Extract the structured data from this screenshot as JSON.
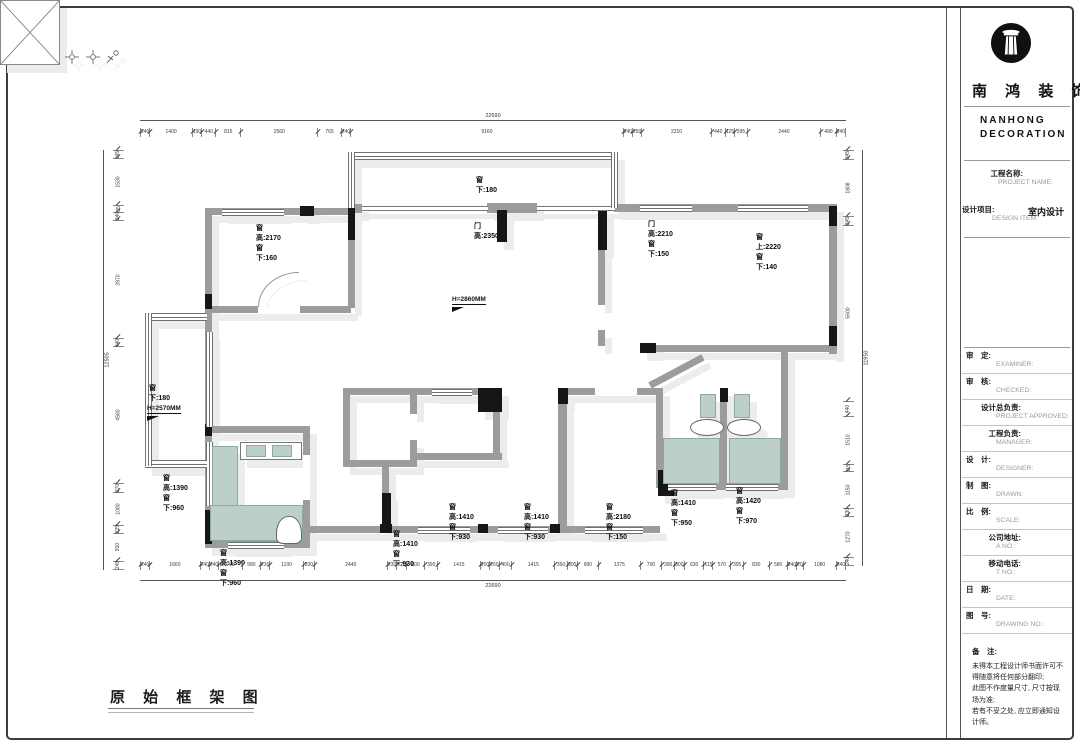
{
  "brand": {
    "cn": "南 鸿 装 饰",
    "en1": "NANHONG",
    "en2": "DECORATION"
  },
  "title_block": {
    "project": {
      "cn": "　　　工程名称:",
      "en": "PROJECT NAME:"
    },
    "design_item": {
      "cn": "设计项目:",
      "en": "DESIGN ITEM:",
      "value": "室内设计"
    },
    "fields": [
      {
        "cn": "审　定:",
        "en": "EXAMINER:"
      },
      {
        "cn": "审　核:",
        "en": "CHECKED:"
      },
      {
        "cn": "　　设计总负责:",
        "en": "PROJECT APPROVED:"
      },
      {
        "cn": "　　　工程负责:",
        "en": "MANAGER:"
      },
      {
        "cn": "设　计:",
        "en": "DESIGNER:"
      },
      {
        "cn": "制　图:",
        "en": "DRAWN:"
      },
      {
        "cn": "比　例:",
        "en": "SCALE:"
      },
      {
        "cn": "　　　公司地址:",
        "en": "A  NO.:"
      },
      {
        "cn": "　　　移动电话:",
        "en": "T  NO.:"
      },
      {
        "cn": "日　期:",
        "en": "DATE:"
      },
      {
        "cn": "图　号:",
        "en": "DRAWING NO.:"
      }
    ],
    "notes": {
      "label": "备　注:",
      "lines": [
        "未得本工程设计师书面许可不",
        "得随意将任何部分翻印;",
        "此图不作度量尺寸, 尺寸按现",
        "场为准;",
        "若有不妥之处, 应立即通知设",
        "计师。"
      ]
    }
  },
  "drawing_title": "原 始 框 架 图",
  "plan": {
    "annotations": [
      {
        "text": "窗高:2170\n窗下:160",
        "x": 256,
        "y": 224
      },
      {
        "text": "窗下:180",
        "x": 476,
        "y": 176
      },
      {
        "text": "门高:2350",
        "x": 474,
        "y": 222
      },
      {
        "text": "门高:2210\n窗下:150",
        "x": 648,
        "y": 220
      },
      {
        "text": "窗上:2220\n窗下:140",
        "x": 756,
        "y": 233
      },
      {
        "text": "窗下:180",
        "x": 149,
        "y": 384
      },
      {
        "text": "窗高:1390\n窗下:960",
        "x": 163,
        "y": 474
      },
      {
        "text": "窗高:1390\n窗下:960",
        "x": 220,
        "y": 549
      },
      {
        "text": "窗高:1410\n窗下:930",
        "x": 393,
        "y": 530
      },
      {
        "text": "窗高:1410\n窗下:930",
        "x": 449,
        "y": 503
      },
      {
        "text": "窗高:1410\n窗下:930",
        "x": 524,
        "y": 503
      },
      {
        "text": "窗高:2180\n窗下:150",
        "x": 606,
        "y": 503
      },
      {
        "text": "窗高:1410\n窗下:950",
        "x": 671,
        "y": 489
      },
      {
        "text": "窗高:1420\n窗下:970",
        "x": 736,
        "y": 487
      }
    ],
    "elevations": [
      {
        "text": "H=2860MM",
        "x": 452,
        "y": 288
      },
      {
        "text": "H=2570MM",
        "x": 147,
        "y": 397
      }
    ],
    "dims": {
      "top_total": "22690",
      "bottom_total": "22690",
      "left_total": "12505",
      "right_total": "11950",
      "top": [
        240,
        1400,
        190,
        440,
        815,
        2560,
        765,
        240,
        9160,
        240,
        250,
        2310,
        440,
        125,
        395,
        2440,
        490,
        240
      ],
      "bottom": [
        240,
        1660,
        240,
        240,
        765,
        580,
        230,
        1100,
        330,
        2440,
        230,
        220,
        600,
        390,
        1415,
        200,
        260,
        400,
        1415,
        390,
        300,
        680,
        1375,
        700,
        390,
        300,
        630,
        115,
        570,
        395,
        830,
        580,
        240,
        20,
        1080,
        240
      ],
      "left": [
        245,
        1530,
        85,
        240,
        3970,
        240,
        4580,
        270,
        1080,
        225,
        910,
        245
      ],
      "right": [
        245,
        1808,
        245,
        5600,
        440,
        1510,
        115,
        1150,
        230,
        1270,
        240
      ]
    }
  }
}
